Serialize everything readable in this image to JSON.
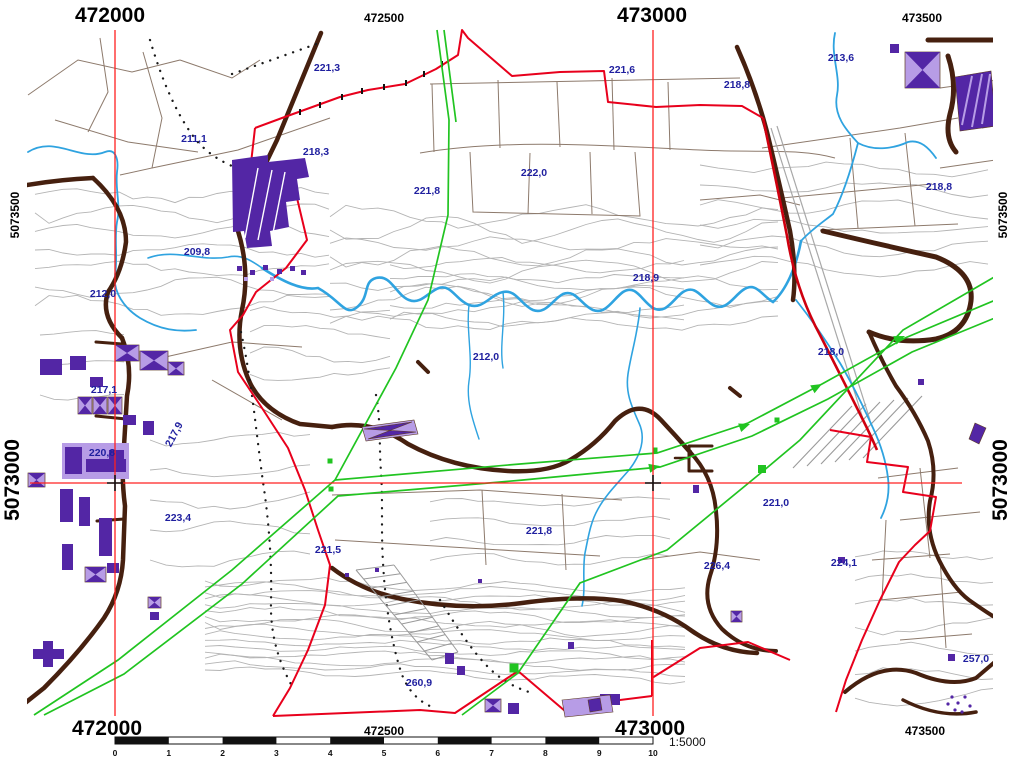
{
  "map": {
    "coordinate_labels": {
      "top": [
        {
          "text": "472000",
          "x": 110,
          "major": true
        },
        {
          "text": "472500",
          "x": 384,
          "major": false
        },
        {
          "text": "473000",
          "x": 652,
          "major": true
        },
        {
          "text": "473500",
          "x": 922,
          "major": false
        }
      ],
      "bottom": [
        {
          "text": "472000",
          "x": 107,
          "major": true
        },
        {
          "text": "472500",
          "x": 384,
          "major": false
        },
        {
          "text": "473000",
          "x": 650,
          "major": true
        },
        {
          "text": "473500",
          "x": 925,
          "major": false
        }
      ],
      "left": [
        {
          "text": "5073500",
          "y": 215,
          "major": false
        },
        {
          "text": "5073000",
          "y": 480,
          "major": true
        }
      ],
      "right": [
        {
          "text": "5073500",
          "y": 215,
          "major": false
        },
        {
          "text": "5073000",
          "y": 480,
          "major": true
        }
      ]
    },
    "elevation_labels": [
      {
        "text": "221,3",
        "x": 327,
        "y": 71
      },
      {
        "text": "221,6",
        "x": 622,
        "y": 73
      },
      {
        "text": "218,8",
        "x": 737,
        "y": 88
      },
      {
        "text": "213,6",
        "x": 841,
        "y": 61
      },
      {
        "text": "211,1",
        "x": 194,
        "y": 142
      },
      {
        "text": "218,3",
        "x": 316,
        "y": 155
      },
      {
        "text": "221,8",
        "x": 427,
        "y": 194
      },
      {
        "text": "222,0",
        "x": 534,
        "y": 176
      },
      {
        "text": "218,8",
        "x": 939,
        "y": 190
      },
      {
        "text": "209,8",
        "x": 197,
        "y": 255
      },
      {
        "text": "212,0",
        "x": 103,
        "y": 297
      },
      {
        "text": "218,9",
        "x": 646,
        "y": 281
      },
      {
        "text": "212,0",
        "x": 486,
        "y": 360
      },
      {
        "text": "218,0",
        "x": 831,
        "y": 355
      },
      {
        "text": "217,1",
        "x": 104,
        "y": 393
      },
      {
        "text": "217,9",
        "x": 177,
        "y": 436,
        "rot": -62
      },
      {
        "text": "220,8",
        "x": 102,
        "y": 456
      },
      {
        "text": "223,4",
        "x": 178,
        "y": 521
      },
      {
        "text": "221,5",
        "x": 328,
        "y": 553
      },
      {
        "text": "221,8",
        "x": 539,
        "y": 534
      },
      {
        "text": "221,0",
        "x": 776,
        "y": 506
      },
      {
        "text": "226,4",
        "x": 717,
        "y": 569
      },
      {
        "text": "224,1",
        "x": 844,
        "y": 566
      },
      {
        "text": "257,0",
        "x": 976,
        "y": 662
      },
      {
        "text": "260,9",
        "x": 419,
        "y": 686
      }
    ],
    "scalebar": {
      "x0": 115,
      "x1": 653,
      "y": 737,
      "height": 7,
      "tick_labels": [
        "0",
        "1",
        "2",
        "3",
        "4",
        "5",
        "6",
        "7",
        "8",
        "9",
        "10"
      ],
      "ratio_text": "1:5000"
    },
    "grid": {
      "x_lines": [
        115,
        653
      ],
      "y_lines": [
        483
      ],
      "crosses": [
        [
          115,
          483
        ],
        [
          653,
          483
        ]
      ]
    }
  },
  "colors": {
    "contour": "#b4b4b4",
    "parcel": "#8d7a6c",
    "stream": "#2fa3e0",
    "road": "#46200f",
    "boundary": "#e8001c",
    "road_red": "#cf000f",
    "grid_red": "#ff2020",
    "utility_green": "#21c421",
    "building_dark": "#5326a5",
    "building_light": "#b79ce6",
    "elevation_text": "#1f1f9f",
    "coordinate_text": "#000000"
  }
}
